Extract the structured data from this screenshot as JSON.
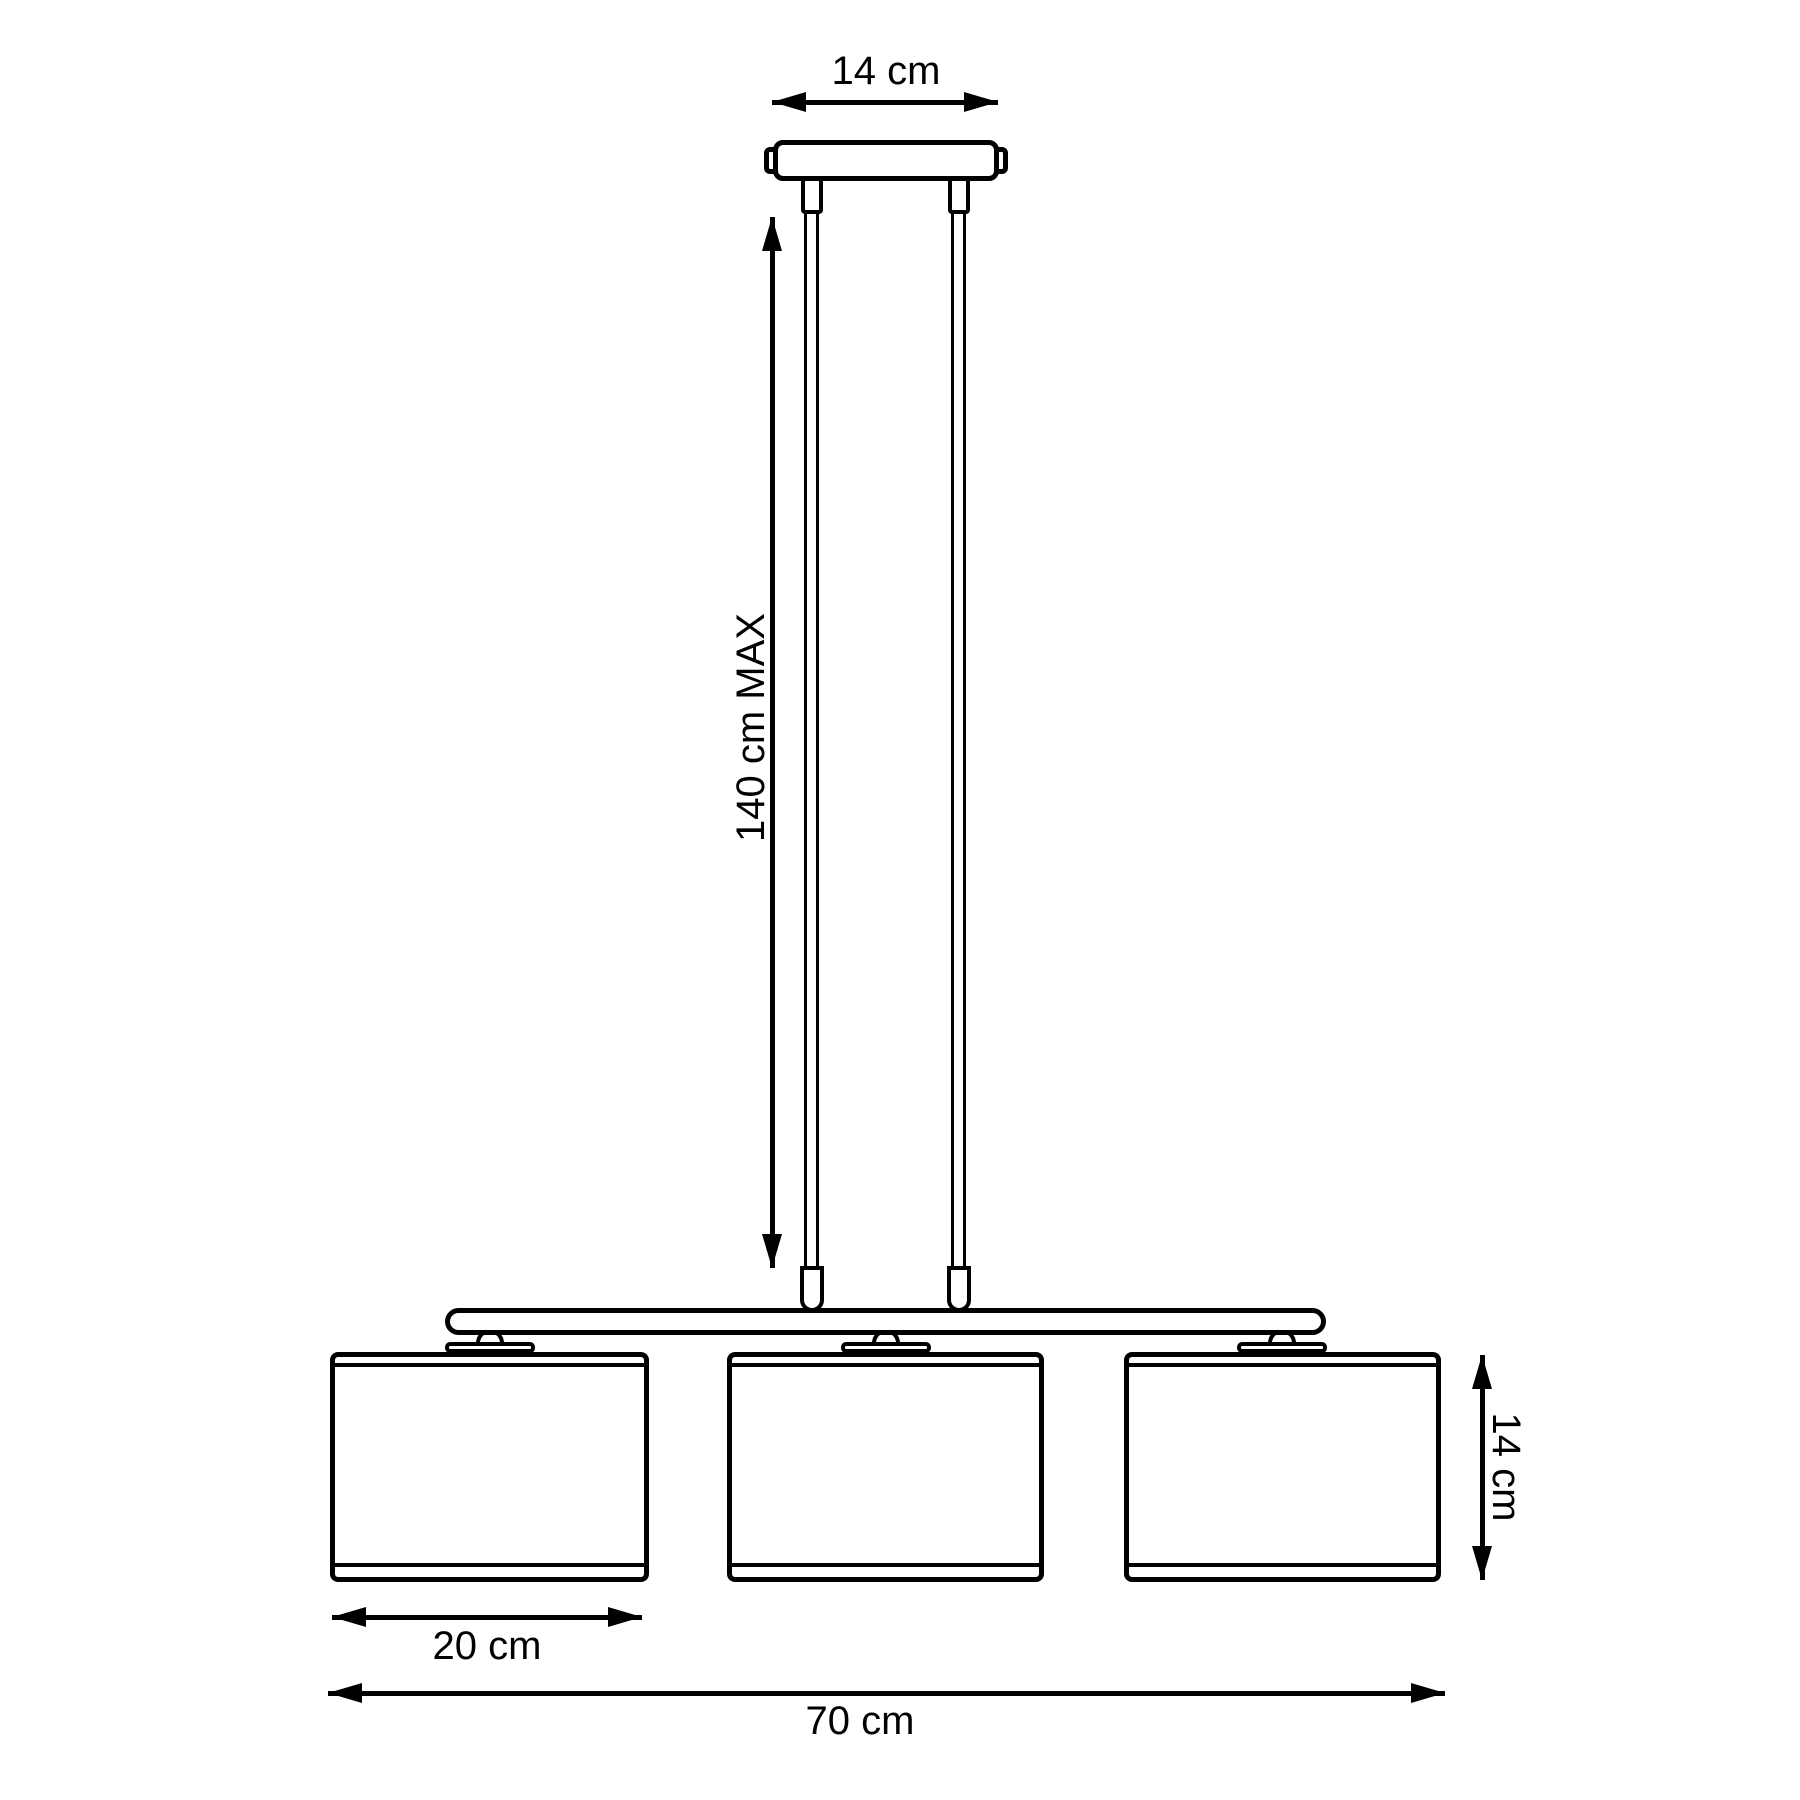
{
  "page": {
    "background": "#ffffff",
    "line_color": "#000000"
  },
  "diagram": {
    "type": "technical-dimension-drawing",
    "subject": "three-shade linear pendant lamp, front elevation with dimensions",
    "dimensions": [
      {
        "id": "canopy-width",
        "label": "14 cm",
        "orientation": "horizontal",
        "position": "top"
      },
      {
        "id": "suspension-height",
        "label": "140 cm MAX",
        "orientation": "vertical",
        "position": "left"
      },
      {
        "id": "shade-width",
        "label": "20 cm",
        "orientation": "horizontal",
        "position": "below-left-shade"
      },
      {
        "id": "total-width",
        "label": "70 cm",
        "orientation": "horizontal",
        "position": "bottom"
      },
      {
        "id": "shade-height",
        "label": "14 cm",
        "orientation": "vertical",
        "position": "right"
      }
    ],
    "parts": {
      "canopy": "ceiling canopy",
      "cables": 2,
      "bar": "horizontal support bar",
      "shades": 3
    }
  }
}
